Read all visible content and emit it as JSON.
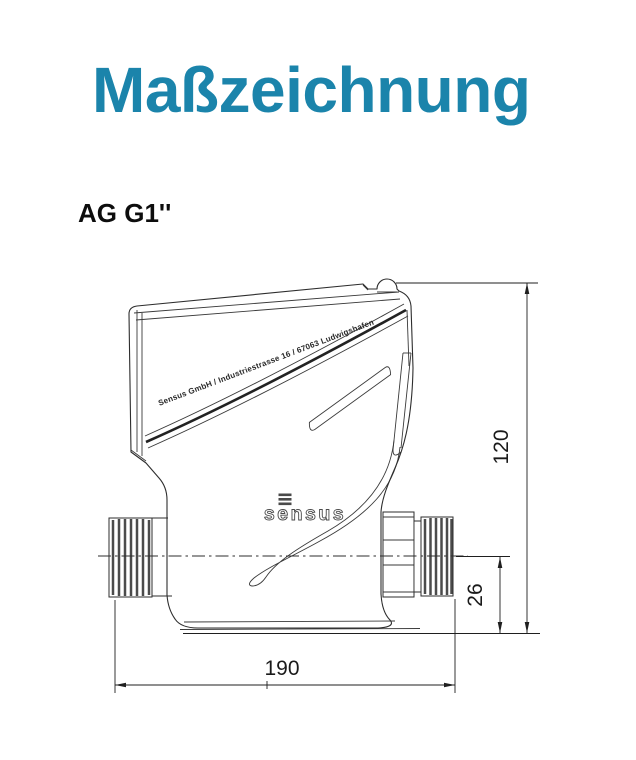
{
  "header": {
    "title": "Maßzeichnung"
  },
  "drawing": {
    "product_label": "AG G1''",
    "device": {
      "address_line": "Sensus GmbH / Industriestrasse 16 / 67063 Ludwigshafen",
      "brand_logo": "sensus"
    },
    "dimensions": {
      "total_height_mm": "120",
      "port_center_height_mm": "26",
      "total_length_mm": "190"
    },
    "colors": {
      "title_accent": "#1b84ab",
      "line": "#2d2d2d"
    }
  }
}
